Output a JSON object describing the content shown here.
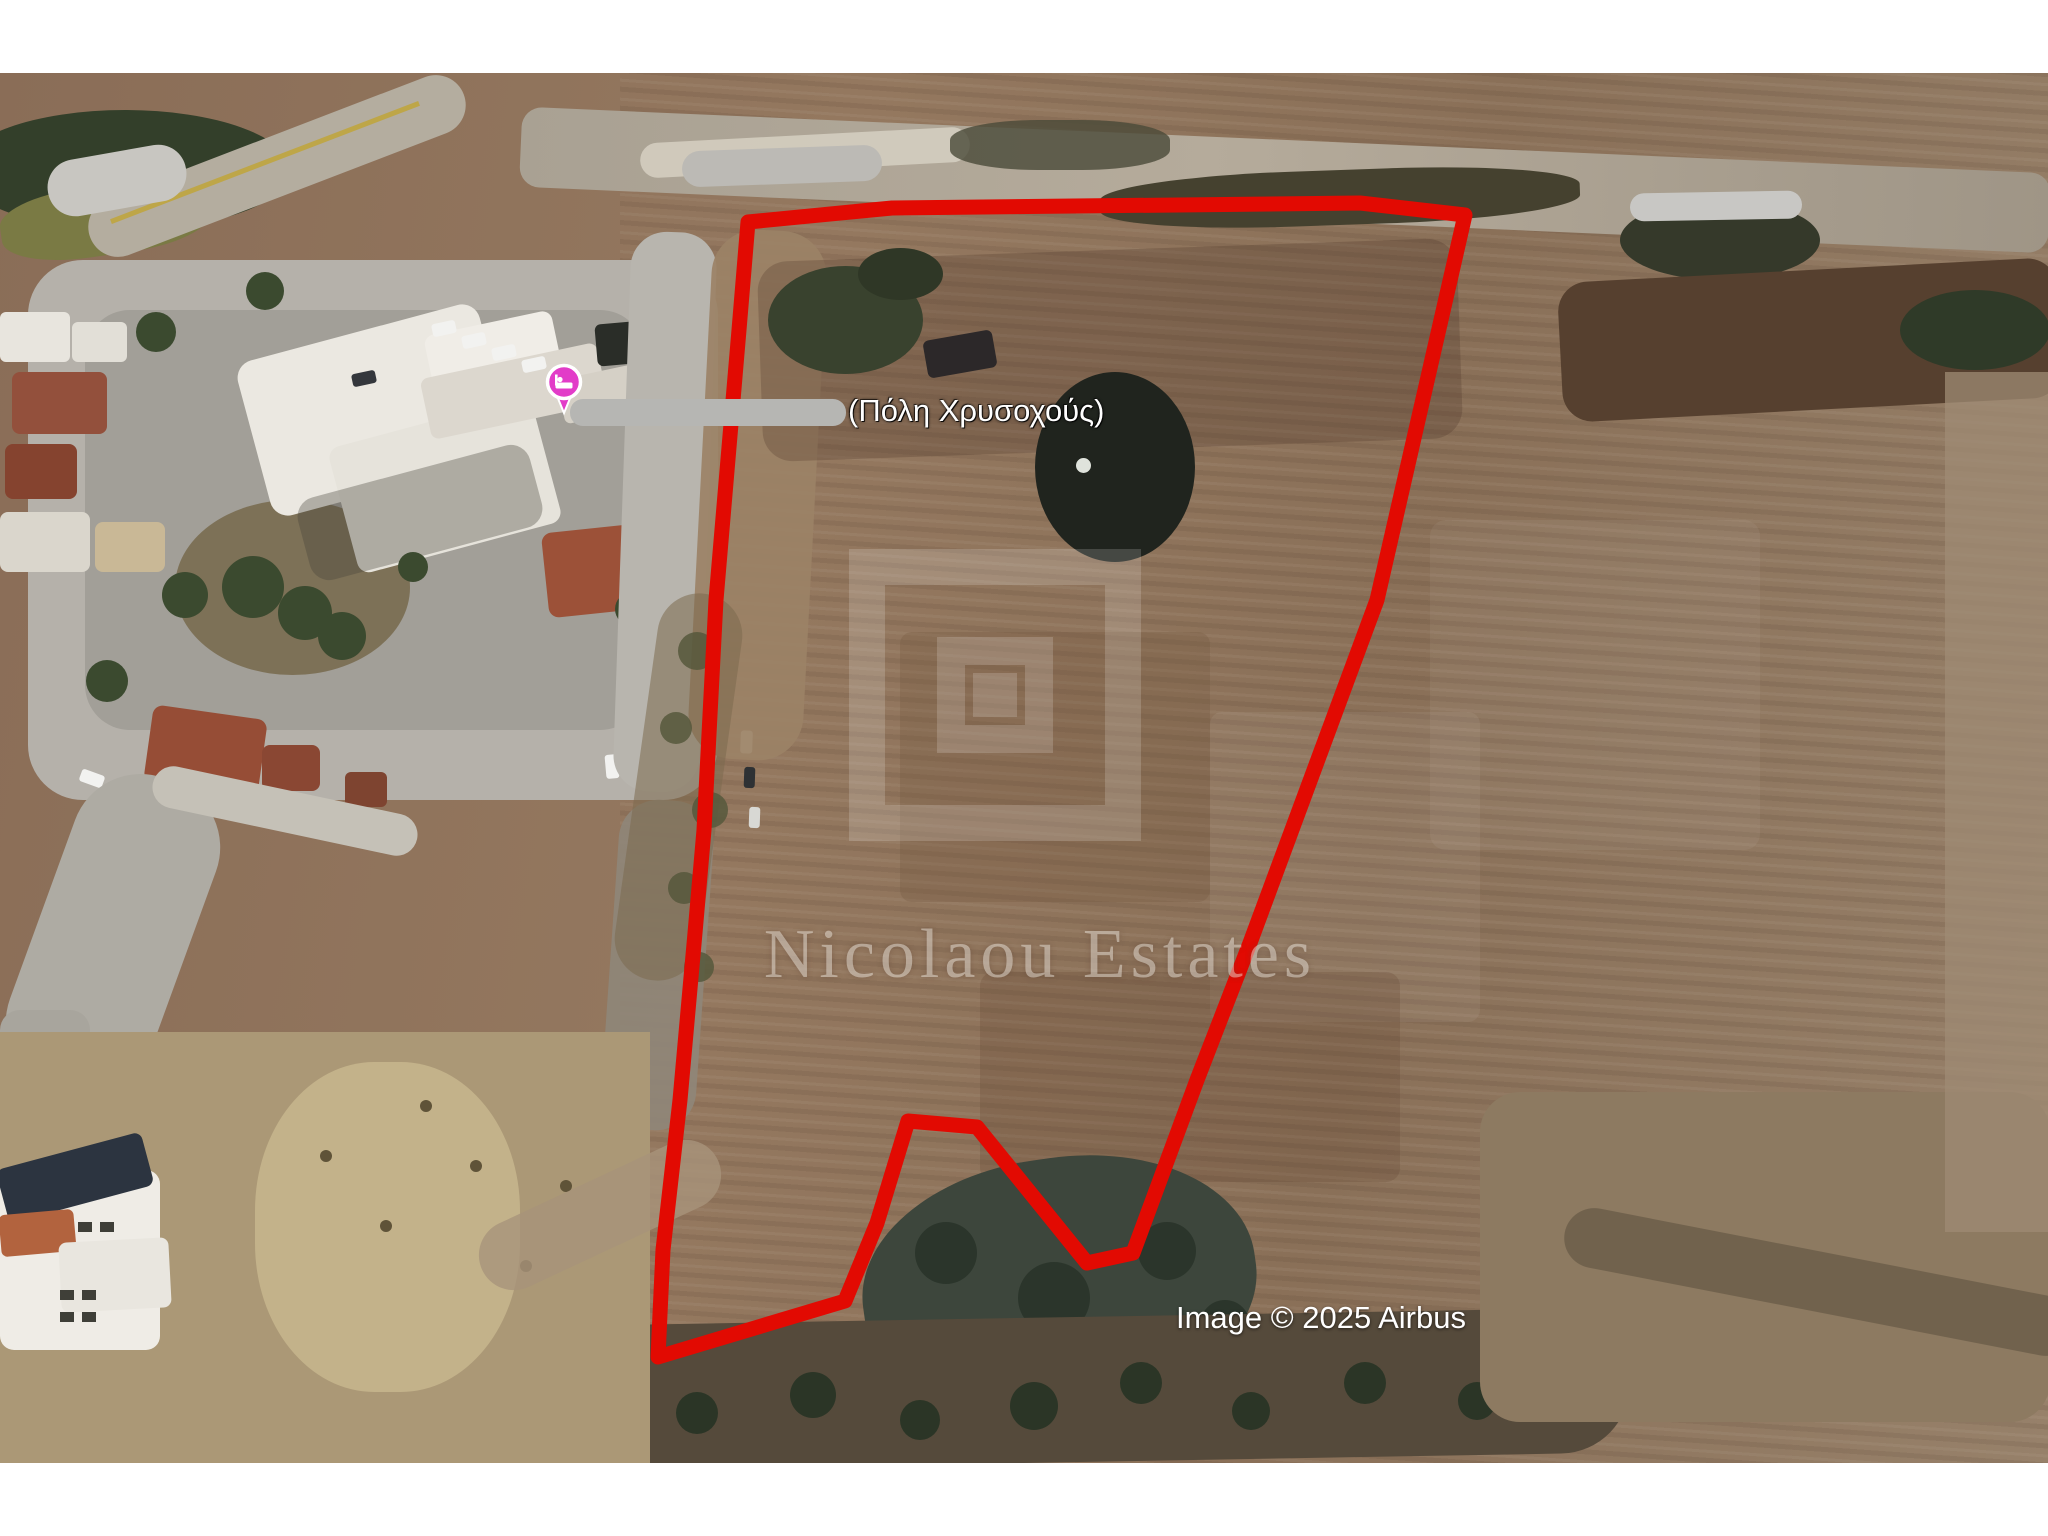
{
  "window": {
    "background": "#ffffff"
  },
  "map": {
    "kind": "satellite-aerial-view",
    "place_label": "(Πόλη Χρυσοχούς)",
    "attribution": "Image © 2025 Airbus",
    "watermark": {
      "brand": "Nicolaou Estates",
      "logo": "nested-squares-logo"
    },
    "marker": {
      "icon": "lodging-pin",
      "color": "#e23cc8"
    },
    "colors": {
      "parcel_outline": "#e20a02",
      "white_margin": "#ffffff",
      "field_base": "#8b6f5a",
      "village_road": "#b5b1aa"
    },
    "parcel_outline_points": [
      [
        748,
        222
      ],
      [
        892,
        208
      ],
      [
        1360,
        203
      ],
      [
        1465,
        215
      ],
      [
        1377,
        600
      ],
      [
        1250,
        943
      ],
      [
        1197,
        1080
      ],
      [
        1133,
        1253
      ],
      [
        1087,
        1263
      ],
      [
        977,
        1127
      ],
      [
        908,
        1121
      ],
      [
        877,
        1223
      ],
      [
        845,
        1301
      ],
      [
        658,
        1357
      ],
      [
        663,
        1250
      ],
      [
        680,
        1100
      ],
      [
        695,
        933
      ],
      [
        704,
        830
      ],
      [
        716,
        600
      ],
      [
        739,
        330
      ]
    ],
    "redactions": [
      {
        "id": "redaction-top-left"
      },
      {
        "id": "redaction-top-center"
      },
      {
        "id": "redaction-top-right"
      },
      {
        "id": "redaction-place-label-prefix"
      }
    ]
  }
}
